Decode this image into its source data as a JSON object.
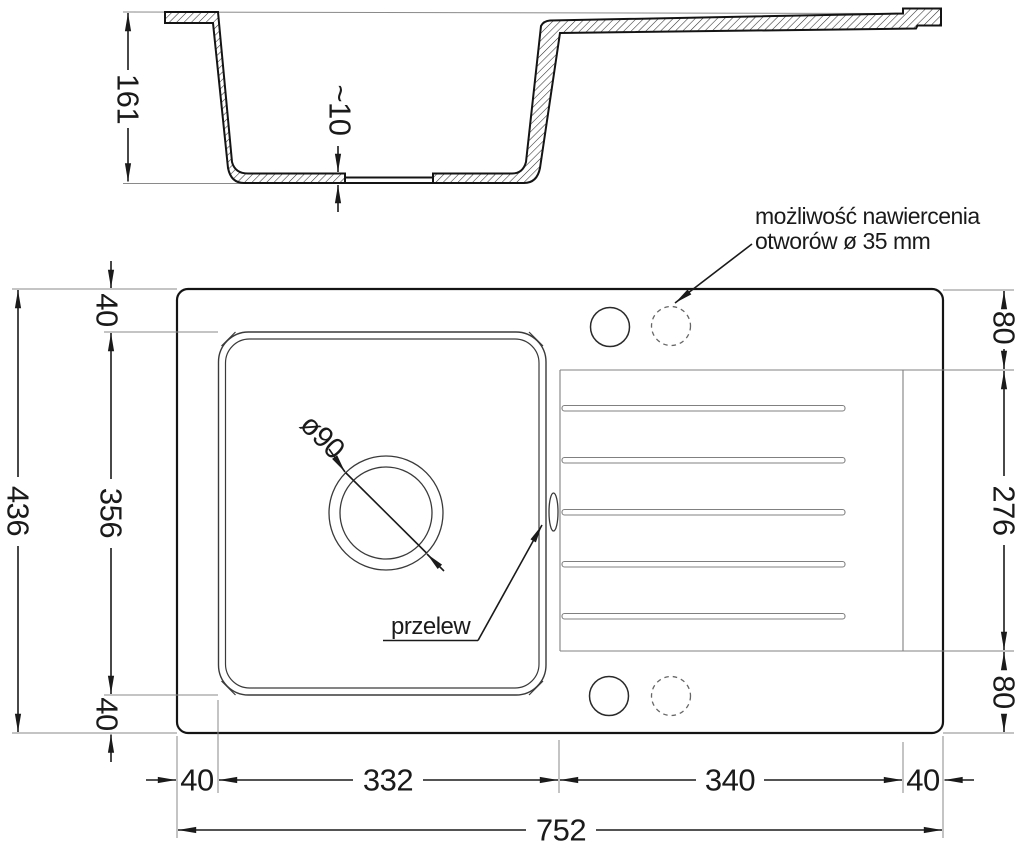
{
  "section_view": {
    "depth_label": "161",
    "bottom_thickness_label": "~10"
  },
  "plan_view": {
    "drill_note_line1": "możliwość nawiercenia",
    "drill_note_line2": "otworów ø 35 mm",
    "overflow_label": "przelew",
    "drain_diameter_label": "ø90",
    "dims": {
      "total_length": "752",
      "total_width": "436",
      "top_rim": "40",
      "basin_width": "356",
      "bottom_rim": "40",
      "left_rim": "40",
      "basin_length": "332",
      "drainer_length": "340",
      "right_rim": "40",
      "drainer_offset_top": "80",
      "drainer_width": "276",
      "drainer_offset_bottom": "80"
    }
  },
  "colors": {
    "outline": "#141414",
    "medium_line": "#3a3a3a",
    "thin_line": "#8a8a8a",
    "dim_line": "#1a1a1a",
    "background": "#ffffff"
  }
}
